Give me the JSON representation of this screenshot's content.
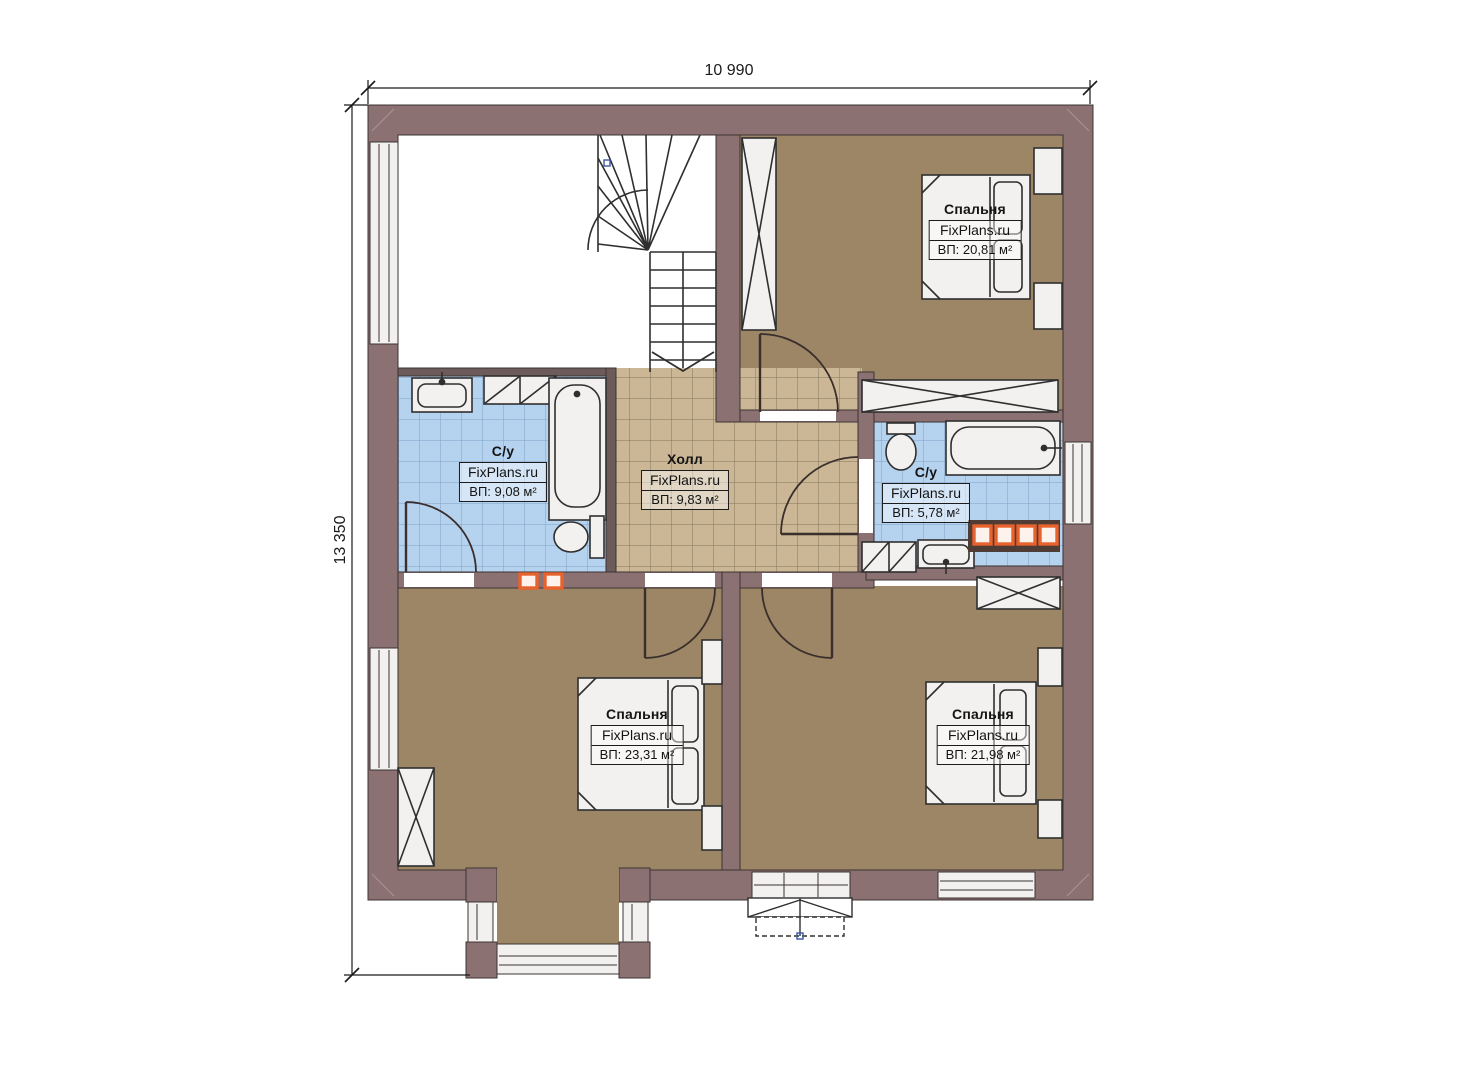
{
  "dimensions": {
    "top": "10 990",
    "left": "13 350"
  },
  "rooms": [
    {
      "name": "Спальня",
      "watermark": "FixPlans.ru",
      "area": "ВП: 20,81 м²"
    },
    {
      "name": "С/у",
      "watermark": "FixPlans.ru",
      "area": "ВП: 9,08 м²"
    },
    {
      "name": "Холл",
      "watermark": "FixPlans.ru",
      "area": "ВП: 9,83 м²"
    },
    {
      "name": "С/у",
      "watermark": "FixPlans.ru",
      "area": "ВП: 5,78 м²"
    },
    {
      "name": "Спальня",
      "watermark": "FixPlans.ru",
      "area": "ВП: 23,31 м²"
    },
    {
      "name": "Спальня",
      "watermark": "FixPlans.ru",
      "area": "ВП: 21,98 м²"
    }
  ],
  "colors": {
    "wall": "#8b7172",
    "bedroom_floor": "#9c8666",
    "hall_floor": "#cbb795",
    "bath_floor": "#b5d2ef",
    "fixture_fill": "#f2f1ef",
    "accent_orange": "#e8622d",
    "line": "#3c3434"
  }
}
